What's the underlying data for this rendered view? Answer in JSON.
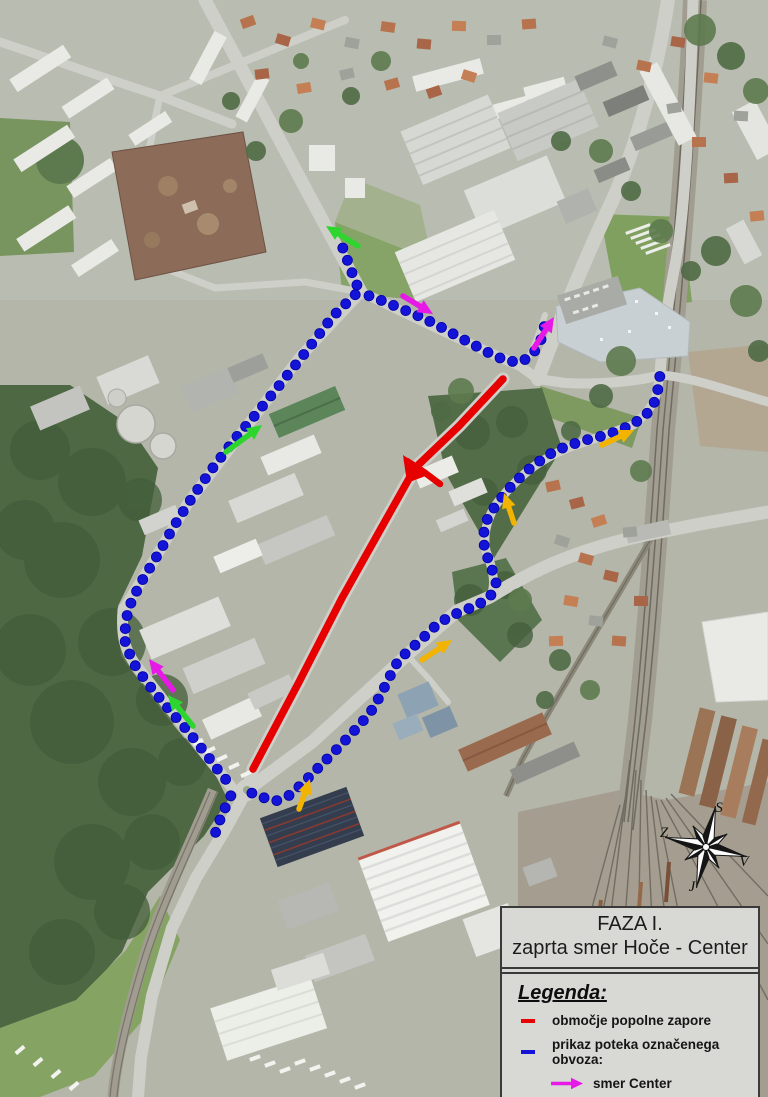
{
  "map": {
    "title_box": {
      "line1": "FAZA I.",
      "line2": "zaprta smer Hoče - Center"
    },
    "legend": {
      "heading": "Legenda:",
      "items": [
        {
          "symbol": "dash",
          "color": "#e60000",
          "label": "območje popolne zapore"
        },
        {
          "symbol": "dash",
          "color": "#1414d8",
          "label": "prikaz poteka označenega obvoza:"
        },
        {
          "symbol": "arrow",
          "color": "#e619e6",
          "label": "smer Center"
        },
        {
          "symbol": "arrow",
          "color": "#2ed52e",
          "label": "smer Dravograd"
        },
        {
          "symbol": "arrow",
          "color": "#f2b400",
          "label": "smer Tezno (Ptuj)"
        }
      ]
    },
    "compass": {
      "north": "S",
      "south": "J",
      "east": "V",
      "west": "Z"
    },
    "overlay": {
      "closure_color": "#e60000",
      "detour_color": "#1414d8",
      "dot_radius": 5,
      "dot_spacing": 13.2,
      "closure_line": [
        [
          503,
          379
        ],
        [
          459,
          426
        ],
        [
          415,
          468
        ],
        [
          379,
          532
        ],
        [
          342,
          598
        ],
        [
          299,
          682
        ],
        [
          263,
          750
        ],
        [
          253,
          769
        ]
      ],
      "closure_branch": [
        [
          407,
          461
        ],
        [
          424,
          472
        ],
        [
          440,
          484
        ]
      ],
      "closure_fork": [
        [
          403,
          455
        ],
        [
          431,
          474
        ],
        [
          407,
          483
        ]
      ],
      "detour_paths": [
        [
          [
            341,
            243
          ],
          [
            348,
            262
          ],
          [
            354,
            278
          ],
          [
            359,
            290
          ]
        ],
        [
          [
            359,
            291
          ],
          [
            333,
            316
          ],
          [
            308,
            349
          ],
          [
            282,
            382
          ],
          [
            257,
            413
          ],
          [
            234,
            440
          ],
          [
            212,
            469
          ],
          [
            193,
            496
          ],
          [
            174,
            526
          ],
          [
            157,
            556
          ],
          [
            140,
            584
          ],
          [
            128,
            609
          ],
          [
            124,
            638
          ],
          [
            132,
            661
          ],
          [
            148,
            684
          ],
          [
            167,
            707
          ],
          [
            187,
            730
          ],
          [
            206,
            754
          ],
          [
            221,
            774
          ],
          [
            234,
            789
          ]
        ],
        [
          [
            233,
            791
          ],
          [
            226,
            806
          ],
          [
            219,
            822
          ],
          [
            214,
            837
          ]
        ],
        [
          [
            364,
            294
          ],
          [
            383,
            301
          ],
          [
            402,
            309
          ],
          [
            421,
            317
          ],
          [
            439,
            326
          ],
          [
            457,
            336
          ],
          [
            474,
            345
          ],
          [
            491,
            354
          ],
          [
            507,
            361
          ],
          [
            521,
            362
          ],
          [
            532,
            355
          ],
          [
            540,
            343
          ],
          [
            544,
            329
          ],
          [
            545,
            315
          ]
        ],
        [
          [
            247,
            791
          ],
          [
            261,
            797
          ],
          [
            276,
            801
          ],
          [
            290,
            795
          ],
          [
            304,
            782
          ],
          [
            320,
            766
          ],
          [
            337,
            749
          ],
          [
            354,
            731
          ],
          [
            370,
            713
          ],
          [
            380,
            696
          ],
          [
            389,
            678
          ],
          [
            398,
            661
          ],
          [
            407,
            652
          ],
          [
            420,
            641
          ],
          [
            433,
            628
          ],
          [
            447,
            618
          ],
          [
            462,
            611
          ],
          [
            476,
            606
          ],
          [
            490,
            597
          ],
          [
            496,
            583
          ],
          [
            491,
            566
          ],
          [
            485,
            551
          ],
          [
            483,
            536
          ],
          [
            487,
            520
          ],
          [
            495,
            506
          ],
          [
            505,
            493
          ],
          [
            516,
            481
          ],
          [
            528,
            470
          ],
          [
            541,
            460
          ],
          [
            555,
            451
          ],
          [
            570,
            445
          ],
          [
            586,
            440
          ],
          [
            602,
            436
          ],
          [
            618,
            431
          ],
          [
            633,
            424
          ],
          [
            646,
            415
          ],
          [
            654,
            403
          ],
          [
            658,
            389
          ],
          [
            660,
            375
          ]
        ]
      ],
      "arrows": [
        {
          "name": "arrow-dravograd-north",
          "color": "#2ed52e",
          "tail": [
            358,
            246
          ],
          "head": [
            326,
            226
          ]
        },
        {
          "name": "arrow-center-mid",
          "color": "#e619e6",
          "tail": [
            403,
            296
          ],
          "head": [
            433,
            314
          ]
        },
        {
          "name": "arrow-center-mall",
          "color": "#e619e6",
          "tail": [
            534,
            348
          ],
          "head": [
            554,
            317
          ]
        },
        {
          "name": "arrow-dravograd-west",
          "color": "#2ed52e",
          "tail": [
            226,
            452
          ],
          "head": [
            262,
            425
          ]
        },
        {
          "name": "arrow-center-southwest",
          "color": "#e619e6",
          "tail": [
            173,
            690
          ],
          "head": [
            149,
            659
          ]
        },
        {
          "name": "arrow-dravograd-southwest",
          "color": "#2ed52e",
          "tail": [
            193,
            726
          ],
          "head": [
            168,
            695
          ]
        },
        {
          "name": "arrow-tezno-south",
          "color": "#f2b400",
          "tail": [
            299,
            809
          ],
          "head": [
            310,
            779
          ]
        },
        {
          "name": "arrow-tezno-mid",
          "color": "#f2b400",
          "tail": [
            422,
            660
          ],
          "head": [
            452,
            640
          ]
        },
        {
          "name": "arrow-tezno-curve",
          "color": "#f2b400",
          "tail": [
            514,
            523
          ],
          "head": [
            504,
            493
          ]
        },
        {
          "name": "arrow-tezno-east",
          "color": "#f2b400",
          "tail": [
            602,
            445
          ],
          "head": [
            634,
            430
          ]
        }
      ]
    }
  }
}
